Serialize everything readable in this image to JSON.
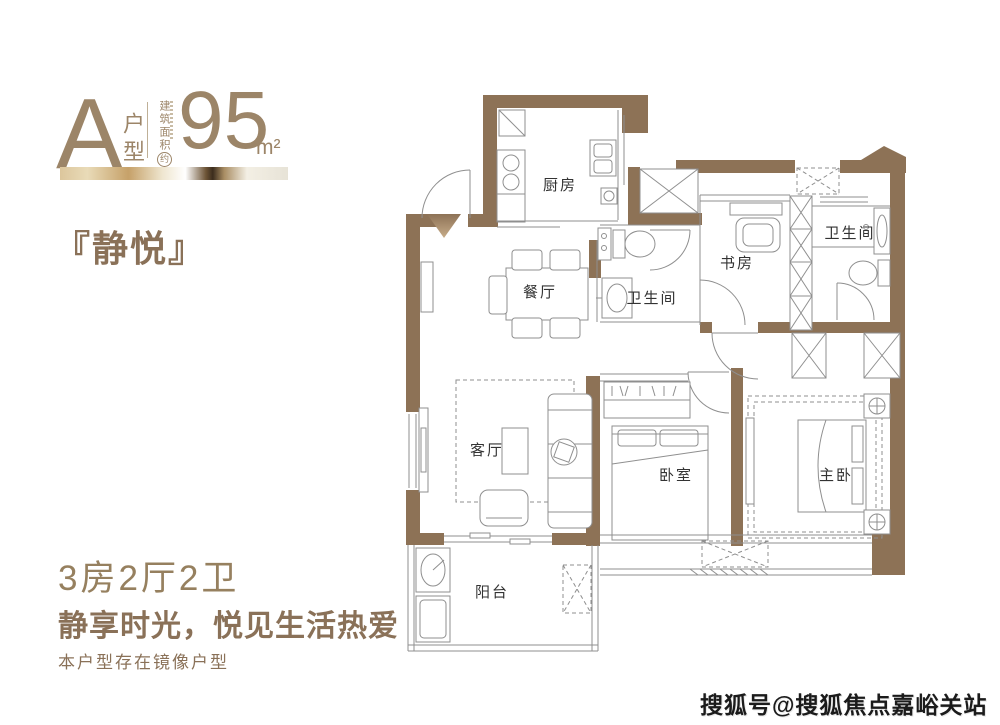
{
  "colors": {
    "accent": "#8a7158",
    "header_text": "#9c8568",
    "wall": "#8d7256",
    "line": "#8f8f8f",
    "watermark": "#1b1b1b"
  },
  "header": {
    "type_letter": "A",
    "type_label": "户型",
    "area_label": "建筑面积",
    "area_approx": "约",
    "area_value": "95",
    "area_unit": "m²"
  },
  "title": "『静悦』",
  "footer": {
    "layout": "3房2厅2卫",
    "slogan": "静享时光，悦见生活热爱",
    "note": "本户型存在镜像户型"
  },
  "watermark": "搜狐号@搜狐焦点嘉峪关站",
  "plan": {
    "rooms": [
      {
        "name": "kitchen",
        "label": "厨房"
      },
      {
        "name": "dining",
        "label": "餐厅"
      },
      {
        "name": "bath-1",
        "label": "卫生间"
      },
      {
        "name": "study",
        "label": "书房"
      },
      {
        "name": "bath-2",
        "label": "卫生间"
      },
      {
        "name": "living",
        "label": "客厅"
      },
      {
        "name": "bedroom",
        "label": "卧室"
      },
      {
        "name": "master-bedroom",
        "label": "主卧"
      },
      {
        "name": "balcony",
        "label": "阳台"
      }
    ]
  }
}
